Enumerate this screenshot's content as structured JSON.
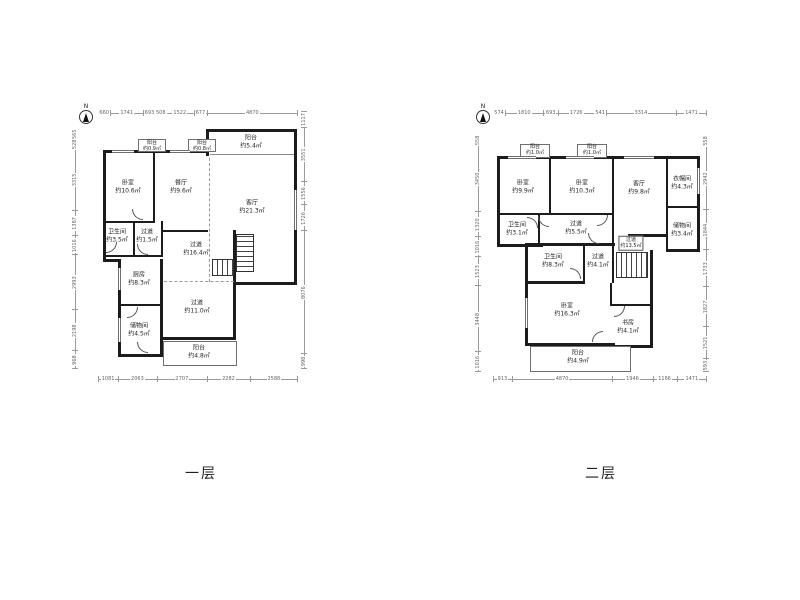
{
  "floor1": {
    "title": "一层",
    "compass": "N",
    "dims": {
      "top": [
        "660",
        "1741",
        "693",
        "508",
        "1522",
        "677",
        "4870"
      ],
      "bottom": [
        "1081",
        "2063",
        "2707",
        "2282",
        "2588"
      ],
      "left": [
        "565",
        "528",
        "3315",
        "1387",
        "1016",
        "2993",
        "2198",
        "968"
      ],
      "right": [
        "1117",
        "3551",
        "1556",
        "1726",
        "8076",
        "998"
      ]
    },
    "rooms": [
      {
        "name": "阳台",
        "area": "约0.9㎡"
      },
      {
        "name": "阳台",
        "area": "约0.8㎡"
      },
      {
        "name": "阳台",
        "area": "约5.4㎡"
      },
      {
        "name": "卧室",
        "area": "约10.6㎡"
      },
      {
        "name": "餐厅",
        "area": "约9.6㎡"
      },
      {
        "name": "客厅",
        "area": "约21.3㎡"
      },
      {
        "name": "卫生间",
        "area": "约3.5㎡"
      },
      {
        "name": "过道",
        "area": "约1.5㎡"
      },
      {
        "name": "过道",
        "area": "约16.4㎡"
      },
      {
        "name": "厨房",
        "area": "约8.3㎡"
      },
      {
        "name": "过道",
        "area": "约11.0㎡"
      },
      {
        "name": "储物间",
        "area": "约4.5㎡"
      },
      {
        "name": "阳台",
        "area": "约4.8㎡"
      }
    ]
  },
  "floor2": {
    "title": "二层",
    "compass": "N",
    "dims": {
      "top": [
        "574",
        "1810",
        "693",
        "1726",
        "541",
        "3314",
        "1471"
      ],
      "bottom": [
        "913",
        "4870",
        "1946",
        "1166",
        "1471"
      ],
      "left": [
        "558",
        "3450",
        "1320",
        "1016",
        "1523",
        "3448",
        "1016"
      ],
      "right": [
        "558",
        "2942",
        "1844",
        "1733",
        "1827",
        "1521",
        "593"
      ]
    },
    "rooms": [
      {
        "name": "阳台",
        "area": "约1.0㎡"
      },
      {
        "name": "阳台",
        "area": "约1.0㎡"
      },
      {
        "name": "卧室",
        "area": "约9.9㎡"
      },
      {
        "name": "卧室",
        "area": "约10.3㎡"
      },
      {
        "name": "客厅",
        "area": "约9.8㎡"
      },
      {
        "name": "衣帽间",
        "area": "约4.3㎡"
      },
      {
        "name": "卫生间",
        "area": "约3.1㎡"
      },
      {
        "name": "过道",
        "area": "约5.5㎡"
      },
      {
        "name": "储物间",
        "area": "约3.4㎡"
      },
      {
        "name": "过道",
        "area": "约13.5㎡"
      },
      {
        "name": "卫生间",
        "area": "约8.3㎡"
      },
      {
        "name": "过道",
        "area": "约4.1㎡"
      },
      {
        "name": "卧室",
        "area": "约16.3㎡"
      },
      {
        "name": "书房",
        "area": "约4.1㎡"
      },
      {
        "name": "阳台",
        "area": "约4.9㎡"
      }
    ]
  }
}
